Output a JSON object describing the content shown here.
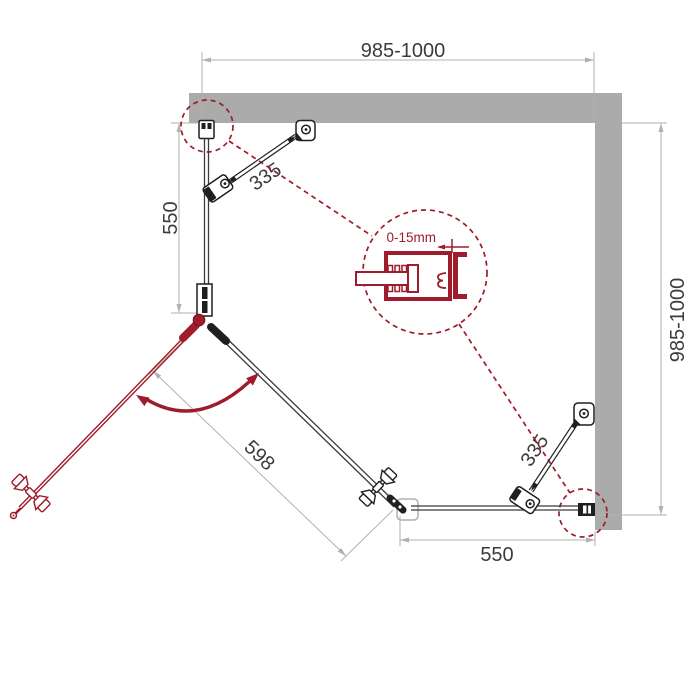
{
  "diagram": {
    "type": "technical-installation-diagram",
    "subject": "pentagonal corner shower enclosure - top view with mounting dimensions",
    "labels": {
      "dim_top_width": "985-1000",
      "dim_right_depth": "985-1000",
      "dim_left_panel": "550",
      "dim_top_brace": "335",
      "dim_bottom_brace": "335",
      "dim_door": "598",
      "dim_bottom_panel": "550",
      "dim_profile_adjustment": "0-15mm"
    },
    "colors": {
      "wall": "#ababab",
      "dim": "#b1b1b1",
      "ink": "#1f1f1f",
      "glass": "#3a3a3a",
      "accent": "#9e1c2b",
      "text": "#3c3c3c",
      "bg": "#ffffff"
    }
  }
}
